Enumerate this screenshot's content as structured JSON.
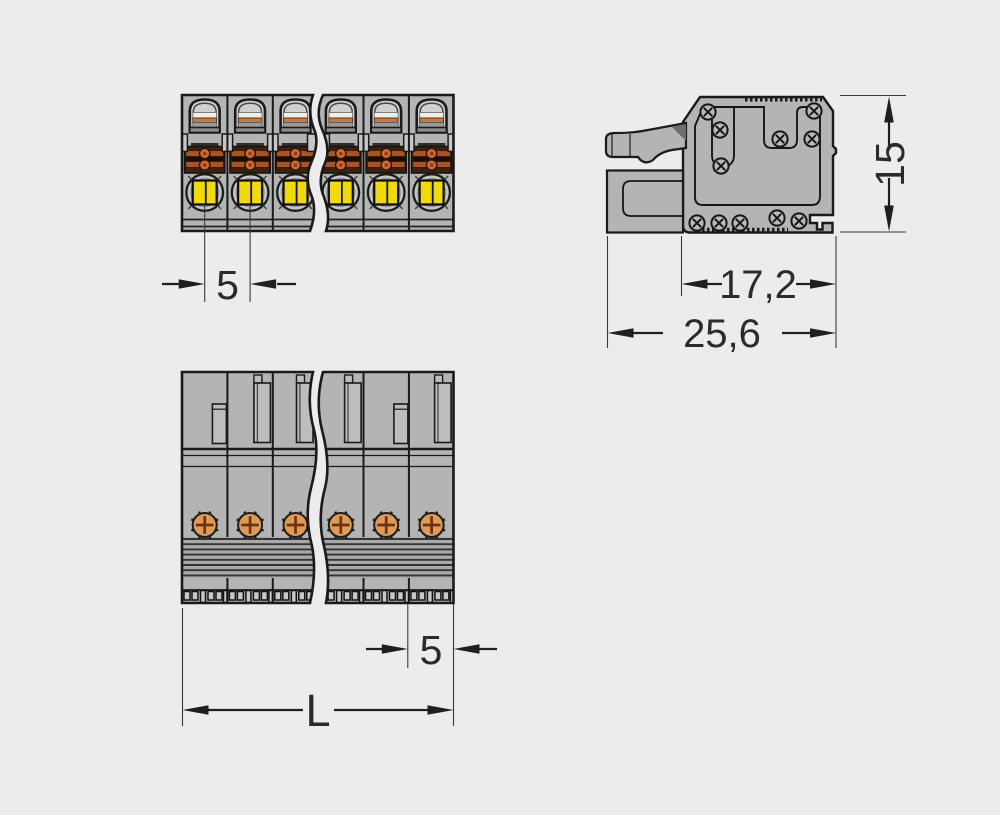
{
  "drawing": {
    "type": "technical-dimensional-drawing",
    "subject": "multi-pole push-button female connector, 3 views with break lines",
    "dimensions": {
      "front_pitch": "5",
      "side_height": "15",
      "side_depth_inner": "17,2",
      "side_depth_total": "25,6",
      "bottom_pitch": "5",
      "bottom_length": "L"
    },
    "colors": {
      "background": "#ececec",
      "line": "#1a1a1a",
      "body_gray": "#b4b4b4",
      "button_yellow": "#f2da05",
      "contact_orange": "#df9a56",
      "clamp_orange": "#a85426",
      "clamp_dark": "#3f2008"
    }
  }
}
